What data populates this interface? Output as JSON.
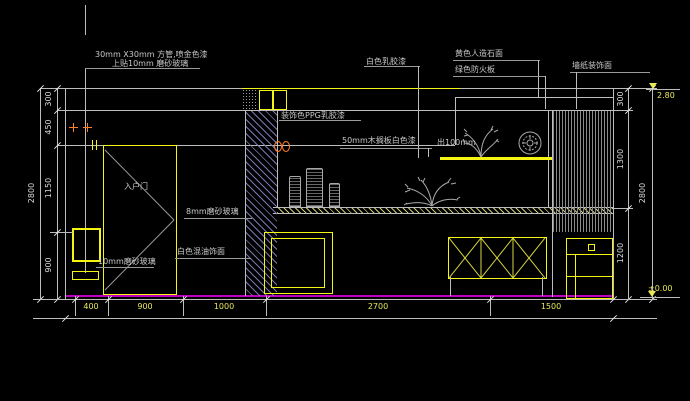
{
  "labels": {
    "tube_note_1": "30mm X30mm 方管,喷金色漆",
    "tube_note_2": "上贴10mm 磨砂玻璃",
    "ppg_paint": "装饰色PPG乳胶漆",
    "white_latex": "白色乳胶漆",
    "shelf_note": "50mm木搁板白色漆",
    "shelf_depth": "出100mm",
    "stone_top": "黄色人造石面",
    "fire_board": "绿色防火板",
    "wallpaper": "墙纸装饰面",
    "glass_8mm": "8mm磨砂玻璃",
    "white_mixed_paint": "白色混油饰面",
    "glass_10mm": "10mm磨砂玻璃",
    "entry_door": "入户门"
  },
  "dims": {
    "left": [
      "300",
      "450",
      "1150",
      "900"
    ],
    "left_total": "2800",
    "right": [
      "300",
      "1300",
      "1200"
    ],
    "right_total": "2800",
    "bottom": [
      "400",
      "900",
      "1000",
      "2700",
      "1500"
    ]
  },
  "levels": {
    "top": "2.80",
    "bottom": "±0.00"
  },
  "colors": {
    "background": "#000000",
    "line": "#bdbdbd",
    "dim_text": "#d8d8d8",
    "dim_text_bottom": "#e8e85a",
    "fixture_yellow": "#f5f515",
    "hatch_blue": "#7d7db9",
    "floor_line_magenta": "#c000c0",
    "marker_orange": "#ff7f27",
    "label_text": "#c8c8c8"
  }
}
